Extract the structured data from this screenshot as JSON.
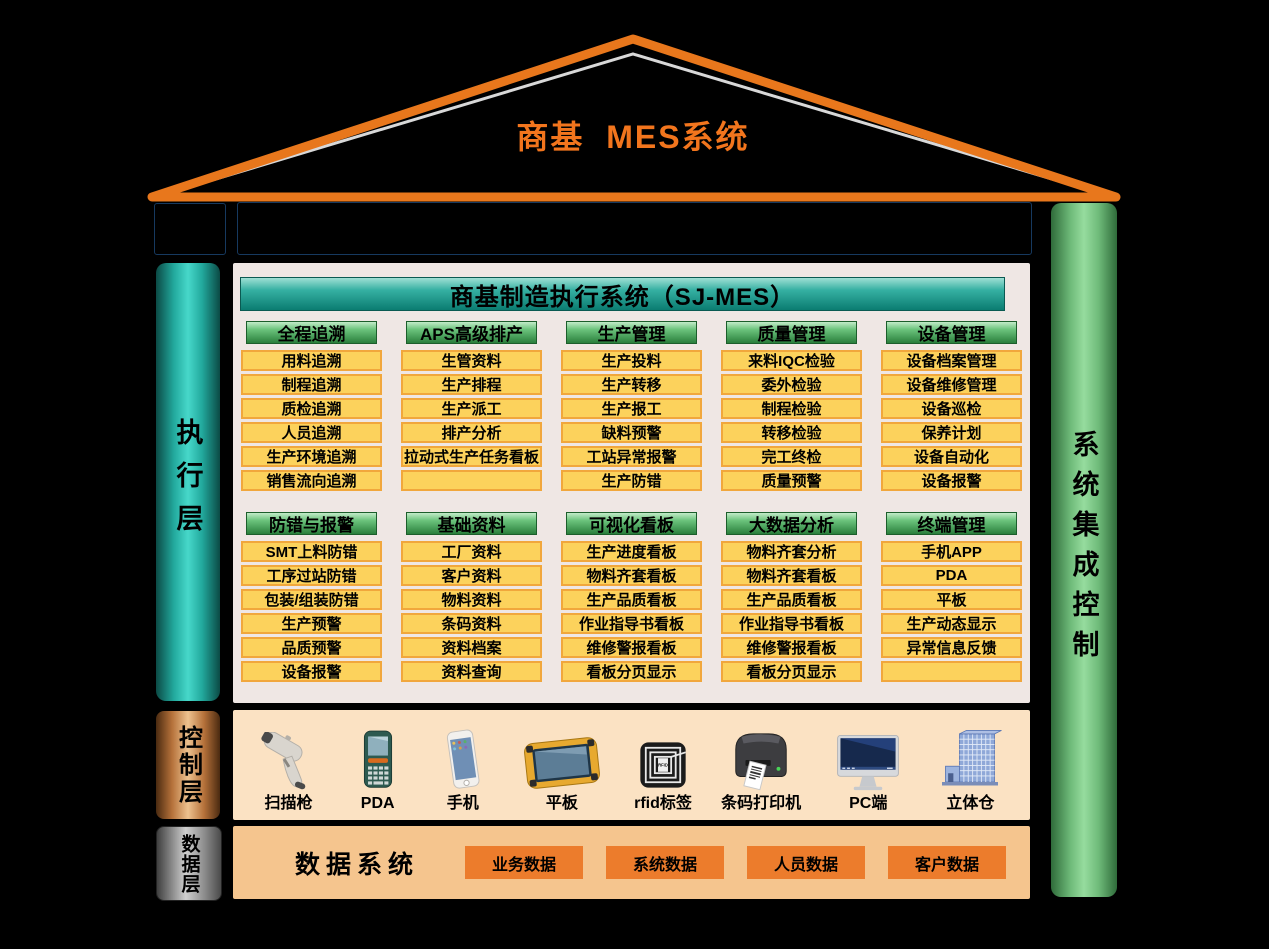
{
  "roof": {
    "title": "商基  MES系统"
  },
  "colors": {
    "background": "#000000",
    "roof_stroke": "#e8771c",
    "title_orange": "#f2751d",
    "erp_blue": "#5b92cc",
    "sjmes_teal": "#0b7c71",
    "group_green": "#2a7f3c",
    "cell_yellow": "#fcd25c",
    "cell_border": "#f1a73c",
    "exec_panel_bg": "#efe7e4",
    "control_panel_bg": "#fbe2c3",
    "data_panel_bg": "#f5c58e",
    "data_btn_orange": "#ec7c2c"
  },
  "planning": {
    "label": "计划层",
    "erp_text": "鼎捷，金蝶，用友，SAP等ERP/其他企业系统"
  },
  "execution": {
    "label": "执行层",
    "header": "商基制造执行系统（SJ-MES）",
    "rows": [
      [
        {
          "name": "全程追溯",
          "items": [
            "用料追溯",
            "制程追溯",
            "质检追溯",
            "人员追溯",
            "生产环境追溯",
            "销售流向追溯"
          ]
        },
        {
          "name": "APS高级排产",
          "items": [
            "生管资料",
            "生产排程",
            "生产派工",
            "排产分析",
            "拉动式生产任务看板",
            ""
          ]
        },
        {
          "name": "生产管理",
          "items": [
            "生产投料",
            "生产转移",
            "生产报工",
            "缺料预警",
            "工站异常报警",
            "生产防错"
          ]
        },
        {
          "name": "质量管理",
          "items": [
            "来料IQC检验",
            "委外检验",
            "制程检验",
            "转移检验",
            "完工终检",
            "质量预警"
          ]
        },
        {
          "name": "设备管理",
          "items": [
            "设备档案管理",
            "设备维修管理",
            "设备巡检",
            "保养计划",
            "设备自动化",
            "设备报警"
          ]
        }
      ],
      [
        {
          "name": "防错与报警",
          "items": [
            "SMT上料防错",
            "工序过站防错",
            "包装/组装防错",
            "生产预警",
            "品质预警",
            "设备报警"
          ]
        },
        {
          "name": "基础资料",
          "items": [
            "工厂资料",
            "客户资料",
            "物料资料",
            "条码资料",
            "资料档案",
            "资料查询"
          ]
        },
        {
          "name": "可视化看板",
          "items": [
            "生产进度看板",
            "物料齐套看板",
            "生产品质看板",
            "作业指导书看板",
            "维修警报看板",
            "看板分页显示"
          ]
        },
        {
          "name": "大数据分析",
          "items": [
            "物料齐套分析",
            "物料齐套看板",
            "生产品质看板",
            "作业指导书看板",
            "维修警报看板",
            "看板分页显示"
          ]
        },
        {
          "name": "终端管理",
          "items": [
            "手机APP",
            "PDA",
            "平板",
            "生产动态显示",
            "异常信息反馈",
            ""
          ]
        }
      ]
    ]
  },
  "control": {
    "label": "控制层",
    "devices": [
      {
        "name": "扫描枪",
        "icon": "scanner-gun-icon"
      },
      {
        "name": "PDA",
        "icon": "pda-icon"
      },
      {
        "name": "手机",
        "icon": "phone-icon"
      },
      {
        "name": "平板",
        "icon": "tablet-icon"
      },
      {
        "name": "rfid标签",
        "icon": "rfid-tag-icon"
      },
      {
        "name": "条码打印机",
        "icon": "barcode-printer-icon"
      },
      {
        "name": "PC端",
        "icon": "pc-monitor-icon"
      },
      {
        "name": "立体仓",
        "icon": "warehouse-icon"
      }
    ]
  },
  "data_layer": {
    "label": "数据层",
    "title": "数据系统",
    "datasets": [
      "业务数据",
      "系统数据",
      "人员数据",
      "客户数据"
    ]
  },
  "integration": {
    "label": "系统集成控制"
  }
}
